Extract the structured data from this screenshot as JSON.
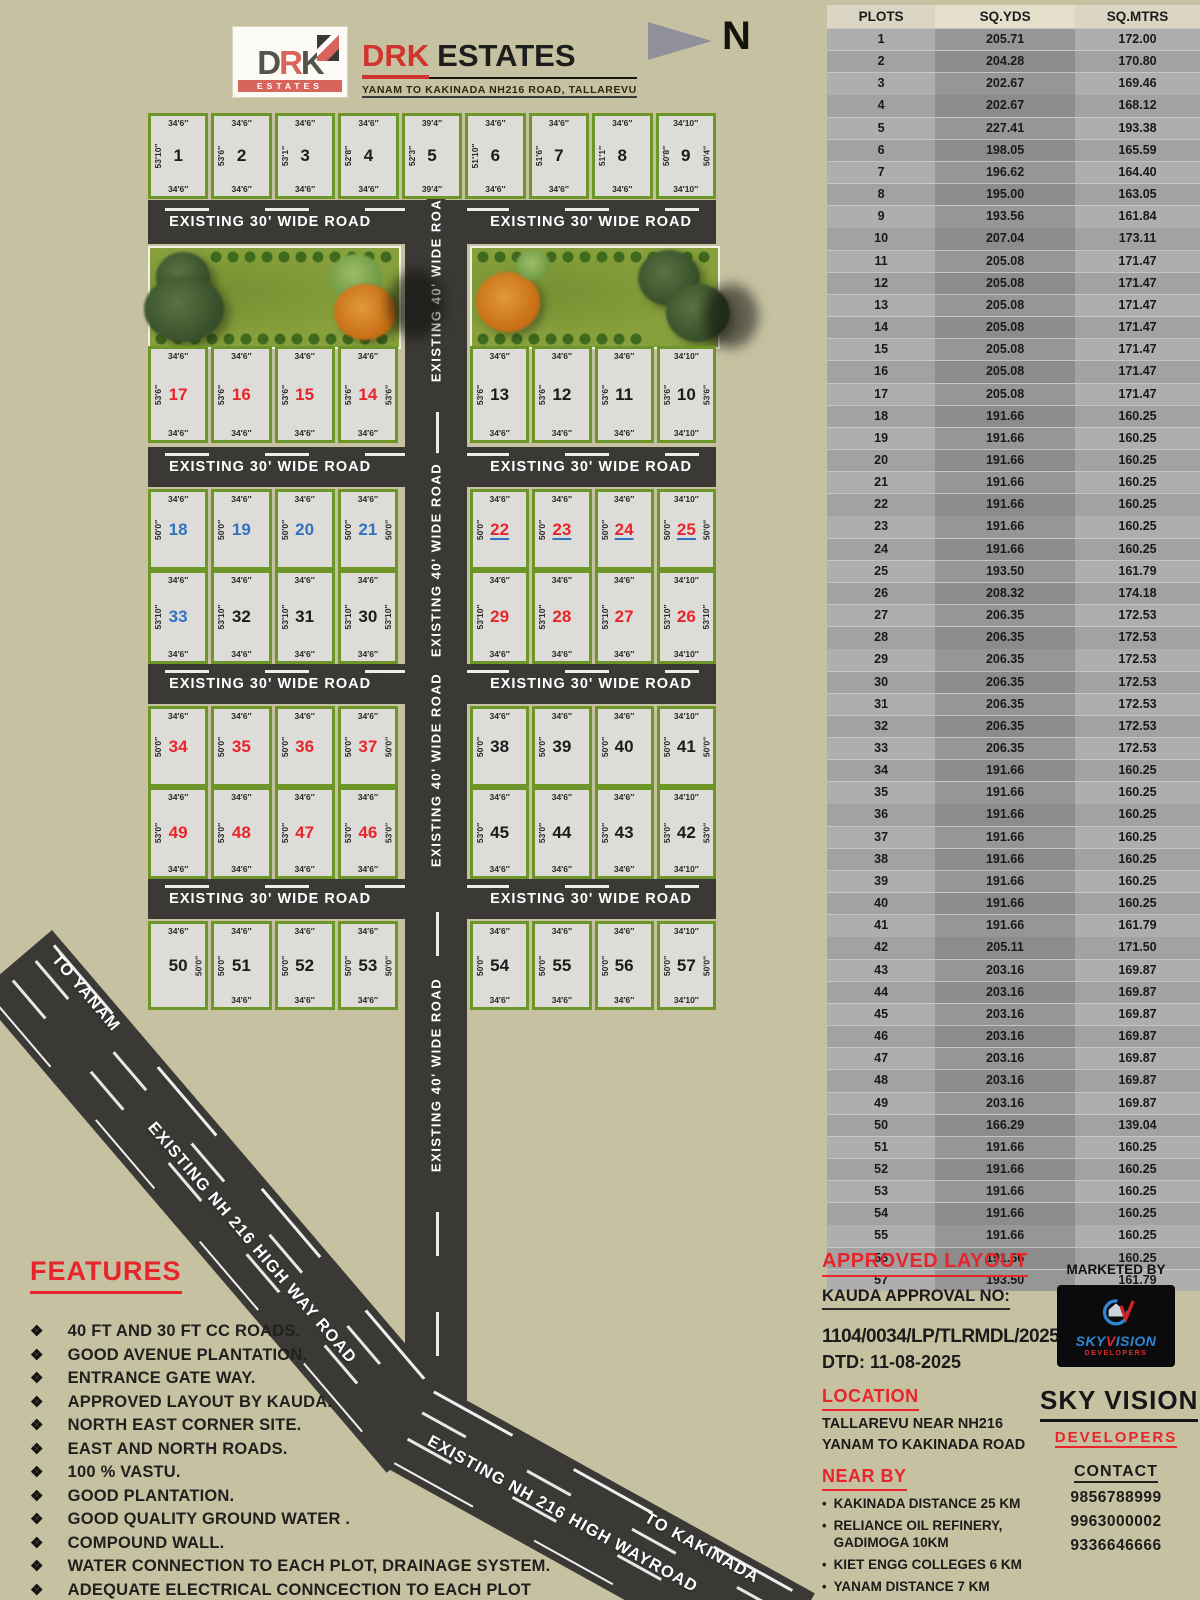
{
  "brand": {
    "logo_top": "DRK",
    "logo_band": "ESTATES",
    "title_red": "DRK",
    "title_black": "ESTATES",
    "subtitle": "YANAM TO KAKINADA NH216 ROAD, TALLAREVU"
  },
  "north_label": "N",
  "plan": {
    "road30_label": "EXISTING 30' WIDE  ROAD",
    "road40_label": "EXISTING 40' WIDE  ROAD",
    "highway_upper_label": "EXISTING NH 216 HIGH WAY ROAD",
    "highway_lower_label": "EXISTING NH 216 HIGH WAYROAD",
    "to_yanam": "TO YANAM",
    "to_kakinada": "TO KAKINADA",
    "hroads": [
      {
        "y": 200,
        "h": 44
      },
      {
        "y": 447,
        "h": 40
      },
      {
        "y": 664,
        "h": 40
      },
      {
        "y": 879,
        "h": 40
      }
    ],
    "rows": [
      {
        "y": 113,
        "h": 86,
        "blocks": [
          {
            "x": 148,
            "w": 568,
            "plots": [
              {
                "n": "1",
                "c": "k",
                "t": "34′6″",
                "b": "34′6″",
                "l": "53′10″"
              },
              {
                "n": "2",
                "c": "k",
                "t": "34′6″",
                "b": "34′6″",
                "l": "53′6″"
              },
              {
                "n": "3",
                "c": "k",
                "t": "34′6″",
                "b": "34′6″",
                "l": "53′1″"
              },
              {
                "n": "4",
                "c": "k",
                "t": "34′6″",
                "b": "34′6″",
                "l": "52′8″"
              },
              {
                "n": "5",
                "c": "k",
                "t": "39′4″",
                "b": "39′4″",
                "l": "52′3″"
              },
              {
                "n": "6",
                "c": "k",
                "t": "34′6″",
                "b": "34′6″",
                "l": "51′10″"
              },
              {
                "n": "7",
                "c": "k",
                "t": "34′6″",
                "b": "34′6″",
                "l": "51′6″"
              },
              {
                "n": "8",
                "c": "k",
                "t": "34′6″",
                "b": "34′6″",
                "l": "51′1″"
              },
              {
                "n": "9",
                "c": "k",
                "t": "34′10″",
                "b": "34′10″",
                "l": "50′8″",
                "r": "50′4″"
              }
            ]
          }
        ]
      },
      {
        "y": 346,
        "h": 97,
        "blocks": [
          {
            "x": 148,
            "w": 250,
            "plots": [
              {
                "n": "17",
                "c": "r",
                "t": "34′6″",
                "b": "34′6″",
                "l": "53′6″"
              },
              {
                "n": "16",
                "c": "r",
                "t": "34′6″",
                "b": "34′6″",
                "l": "53′6″"
              },
              {
                "n": "15",
                "c": "r",
                "t": "34′6″",
                "b": "34′6″",
                "l": "53′6″"
              },
              {
                "n": "14",
                "c": "r",
                "t": "34′6″",
                "b": "34′6″",
                "l": "53′6″",
                "r": "53′6″"
              }
            ]
          },
          {
            "x": 470,
            "w": 246,
            "plots": [
              {
                "n": "13",
                "c": "k",
                "t": "34′6″",
                "b": "34′6″",
                "l": "53′6″"
              },
              {
                "n": "12",
                "c": "k",
                "t": "34′6″",
                "b": "34′6″",
                "l": "53′6″"
              },
              {
                "n": "11",
                "c": "k",
                "t": "34′6″",
                "b": "34′6″",
                "l": "53′6″"
              },
              {
                "n": "10",
                "c": "k",
                "t": "34′10″",
                "b": "34′10″",
                "l": "53′6″",
                "r": "53′6″"
              }
            ]
          }
        ]
      },
      {
        "y": 489,
        "h": 81,
        "blocks": [
          {
            "x": 148,
            "w": 250,
            "plots": [
              {
                "n": "18",
                "c": "b",
                "t": "34′6″",
                "l": "50′0″"
              },
              {
                "n": "19",
                "c": "b",
                "t": "34′6″",
                "l": "50′0″"
              },
              {
                "n": "20",
                "c": "b",
                "t": "34′6″",
                "l": "50′0″"
              },
              {
                "n": "21",
                "c": "b",
                "t": "34′6″",
                "l": "50′0″",
                "r": "50′0″"
              }
            ]
          },
          {
            "x": 470,
            "w": 246,
            "plots": [
              {
                "n": "22",
                "c": "ru",
                "t": "34′6″",
                "l": "50′0″"
              },
              {
                "n": "23",
                "c": "ru",
                "t": "34′6″",
                "l": "50′0″"
              },
              {
                "n": "24",
                "c": "ru",
                "t": "34′6″",
                "l": "50′0″"
              },
              {
                "n": "25",
                "c": "ru",
                "t": "34′10″",
                "l": "50′0″",
                "r": "50′0″"
              }
            ]
          }
        ]
      },
      {
        "y": 570,
        "h": 94,
        "blocks": [
          {
            "x": 148,
            "w": 250,
            "plots": [
              {
                "n": "33",
                "c": "b",
                "t": "34′6″",
                "b": "34′6″",
                "l": "53′10″"
              },
              {
                "n": "32",
                "c": "k",
                "t": "34′6″",
                "b": "34′6″",
                "l": "53′10″"
              },
              {
                "n": "31",
                "c": "k",
                "t": "34′6″",
                "b": "34′6″",
                "l": "53′10″"
              },
              {
                "n": "30",
                "c": "k",
                "t": "34′6″",
                "b": "34′6″",
                "l": "53′10″",
                "r": "53′10″"
              }
            ]
          },
          {
            "x": 470,
            "w": 246,
            "plots": [
              {
                "n": "29",
                "c": "r",
                "t": "34′6″",
                "b": "34′6″",
                "l": "53′10″"
              },
              {
                "n": "28",
                "c": "r",
                "t": "34′6″",
                "b": "34′6″",
                "l": "53′10″"
              },
              {
                "n": "27",
                "c": "r",
                "t": "34′6″",
                "b": "34′6″",
                "l": "53′10″"
              },
              {
                "n": "26",
                "c": "r",
                "t": "34′10″",
                "b": "34′10″",
                "l": "53′10″",
                "r": "53′10″"
              }
            ]
          }
        ]
      },
      {
        "y": 706,
        "h": 81,
        "blocks": [
          {
            "x": 148,
            "w": 250,
            "plots": [
              {
                "n": "34",
                "c": "r",
                "t": "34′6″",
                "l": "50′0″"
              },
              {
                "n": "35",
                "c": "r",
                "t": "34′6″",
                "l": "50′0″"
              },
              {
                "n": "36",
                "c": "r",
                "t": "34′6″",
                "l": "50′0″"
              },
              {
                "n": "37",
                "c": "r",
                "t": "34′6″",
                "l": "50′0″",
                "r": "50′0″"
              }
            ]
          },
          {
            "x": 470,
            "w": 246,
            "plots": [
              {
                "n": "38",
                "c": "k",
                "t": "34′6″",
                "l": "50′0″"
              },
              {
                "n": "39",
                "c": "k",
                "t": "34′6″",
                "l": "50′0″"
              },
              {
                "n": "40",
                "c": "k",
                "t": "34′6″",
                "l": "50′0″"
              },
              {
                "n": "41",
                "c": "k",
                "t": "34′10″",
                "l": "50′0″",
                "r": "50′0″"
              }
            ]
          }
        ]
      },
      {
        "y": 787,
        "h": 92,
        "blocks": [
          {
            "x": 148,
            "w": 250,
            "plots": [
              {
                "n": "49",
                "c": "r",
                "t": "34′6″",
                "b": "34′6″",
                "l": "53′0″"
              },
              {
                "n": "48",
                "c": "r",
                "t": "34′6″",
                "b": "34′6″",
                "l": "53′0″"
              },
              {
                "n": "47",
                "c": "r",
                "t": "34′6″",
                "b": "34′6″",
                "l": "53′0″"
              },
              {
                "n": "46",
                "c": "r",
                "t": "34′6″",
                "b": "34′6″",
                "l": "53′0″",
                "r": "53′0″"
              }
            ]
          },
          {
            "x": 470,
            "w": 246,
            "plots": [
              {
                "n": "45",
                "c": "k",
                "t": "34′6″",
                "b": "34′6″",
                "l": "53′0″"
              },
              {
                "n": "44",
                "c": "k",
                "t": "34′6″",
                "b": "34′6″",
                "l": "53′0″"
              },
              {
                "n": "43",
                "c": "k",
                "t": "34′6″",
                "b": "34′6″",
                "l": "53′0″"
              },
              {
                "n": "42",
                "c": "k",
                "t": "34′10″",
                "b": "34′10″",
                "l": "53′0″",
                "r": "53′0″"
              }
            ]
          }
        ]
      },
      {
        "y": 921,
        "h": 89,
        "blocks": [
          {
            "x": 148,
            "w": 250,
            "plots": [
              {
                "n": "50",
                "c": "k",
                "t": "34′6″",
                "r": "50′0″"
              },
              {
                "n": "51",
                "c": "k",
                "t": "34′6″",
                "b": "34′6″",
                "l": "50′0″"
              },
              {
                "n": "52",
                "c": "k",
                "t": "34′6″",
                "b": "34′6″",
                "l": "50′0″"
              },
              {
                "n": "53",
                "c": "k",
                "t": "34′6″",
                "b": "34′6″",
                "l": "50′0″",
                "r": "50′0″"
              }
            ]
          },
          {
            "x": 470,
            "w": 246,
            "plots": [
              {
                "n": "54",
                "c": "k",
                "t": "34′6″",
                "b": "34′6″",
                "l": "50′0″"
              },
              {
                "n": "55",
                "c": "k",
                "t": "34′6″",
                "b": "34′6″",
                "l": "50′0″"
              },
              {
                "n": "56",
                "c": "k",
                "t": "34′6″",
                "b": "34′6″",
                "l": "50′0″"
              },
              {
                "n": "57",
                "c": "k",
                "t": "34′10″",
                "b": "34′10″",
                "l": "50′0″",
                "r": "50′0″"
              }
            ]
          }
        ]
      }
    ]
  },
  "table": {
    "headers": [
      "PLOTS",
      "SQ.YDS",
      "SQ.MTRS"
    ],
    "rows": [
      [
        "1",
        "205.71",
        "172.00"
      ],
      [
        "2",
        "204.28",
        "170.80"
      ],
      [
        "3",
        "202.67",
        "169.46"
      ],
      [
        "4",
        "202.67",
        "168.12"
      ],
      [
        "5",
        "227.41",
        "193.38"
      ],
      [
        "6",
        "198.05",
        "165.59"
      ],
      [
        "7",
        "196.62",
        "164.40"
      ],
      [
        "8",
        "195.00",
        "163.05"
      ],
      [
        "9",
        "193.56",
        "161.84"
      ],
      [
        "10",
        "207.04",
        "173.11"
      ],
      [
        "11",
        "205.08",
        "171.47"
      ],
      [
        "12",
        "205.08",
        "171.47"
      ],
      [
        "13",
        "205.08",
        "171.47"
      ],
      [
        "14",
        "205.08",
        "171.47"
      ],
      [
        "15",
        "205.08",
        "171.47"
      ],
      [
        "16",
        "205.08",
        "171.47"
      ],
      [
        "17",
        "205.08",
        "171.47"
      ],
      [
        "18",
        "191.66",
        "160.25"
      ],
      [
        "19",
        "191.66",
        "160.25"
      ],
      [
        "20",
        "191.66",
        "160.25"
      ],
      [
        "21",
        "191.66",
        "160.25"
      ],
      [
        "22",
        "191.66",
        "160.25"
      ],
      [
        "23",
        "191.66",
        "160.25"
      ],
      [
        "24",
        "191.66",
        "160.25"
      ],
      [
        "25",
        "193.50",
        "161.79"
      ],
      [
        "26",
        "208.32",
        "174.18"
      ],
      [
        "27",
        "206.35",
        "172.53"
      ],
      [
        "28",
        "206.35",
        "172.53"
      ],
      [
        "29",
        "206.35",
        "172.53"
      ],
      [
        "30",
        "206.35",
        "172.53"
      ],
      [
        "31",
        "206.35",
        "172.53"
      ],
      [
        "32",
        "206.35",
        "172.53"
      ],
      [
        "33",
        "206.35",
        "172.53"
      ],
      [
        "34",
        "191.66",
        "160.25"
      ],
      [
        "35",
        "191.66",
        "160.25"
      ],
      [
        "36",
        "191.66",
        "160.25"
      ],
      [
        "37",
        "191.66",
        "160.25"
      ],
      [
        "38",
        "191.66",
        "160.25"
      ],
      [
        "39",
        "191.66",
        "160.25"
      ],
      [
        "40",
        "191.66",
        "160.25"
      ],
      [
        "41",
        "191.66",
        "161.79"
      ],
      [
        "42",
        "205.11",
        "171.50"
      ],
      [
        "43",
        "203.16",
        "169.87"
      ],
      [
        "44",
        "203.16",
        "169.87"
      ],
      [
        "45",
        "203.16",
        "169.87"
      ],
      [
        "46",
        "203.16",
        "169.87"
      ],
      [
        "47",
        "203.16",
        "169.87"
      ],
      [
        "48",
        "203.16",
        "169.87"
      ],
      [
        "49",
        "203.16",
        "169.87"
      ],
      [
        "50",
        "166.29",
        "139.04"
      ],
      [
        "51",
        "191.66",
        "160.25"
      ],
      [
        "52",
        "191.66",
        "160.25"
      ],
      [
        "53",
        "191.66",
        "160.25"
      ],
      [
        "54",
        "191.66",
        "160.25"
      ],
      [
        "55",
        "191.66",
        "160.25"
      ],
      [
        "56",
        "191.66",
        "160.25"
      ],
      [
        "57",
        "193.50",
        "161.79"
      ]
    ]
  },
  "features": {
    "title": "FEATURES",
    "bullet": "❖",
    "items": [
      "40 FT AND 30 FT CC ROADS.",
      "GOOD AVENUE PLANTATION.",
      "ENTRANCE GATE WAY.",
      "APPROVED LAYOUT BY KAUDA.",
      "NORTH EAST CORNER SITE.",
      "EAST AND NORTH ROADS.",
      "100 % VASTU.",
      "GOOD PLANTATION.",
      "GOOD QUALITY GROUND WATER .",
      "COMPOUND WALL.",
      "WATER CONNECTION TO EACH PLOT, DRAINAGE SYSTEM.",
      "ADEQUATE  ELECTRICAL CONNCECTION TO EACH PLOT"
    ]
  },
  "info": {
    "approved_title": "APPROVED LAYOUT",
    "kauda": "KAUDA APPROVAL NO:",
    "approval_no": "1104/0034/LP/TLRMDL/2025",
    "dtd": "DTD: 11-08-2025",
    "location_title": "LOCATION",
    "location_lines": [
      "TALLAREVU NEAR NH216",
      "YANAM TO KAKINADA ROAD"
    ],
    "nearby_title": "NEAR BY",
    "nearby_bullet": "•",
    "nearby_items": [
      "KAKINADA DISTANCE 25 KM",
      "RELIANCE OIL REFINERY, GADIMOGA 10KM",
      "KIET ENGG COLLEGES 6 KM",
      "YANAM DISTANCE 7 KM"
    ],
    "marketed_by": "MARKETED BY",
    "logo_sky": "SKY",
    "logo_v": "V",
    "logo_ision": "ISION",
    "logo_sub": "DEVELOPERS",
    "developer_name": "SKY VISION",
    "developer_sub": "DEVELOPERS",
    "contact_title": "CONTACT",
    "phones": [
      "9856788999",
      "9963000002",
      "9336646666"
    ]
  },
  "colors": {
    "background": "#c6c2a1",
    "road": "#3a3936",
    "plot_border_green": "#6e9527",
    "accent_red": "#e8252b",
    "accent_blue": "#2f74c0"
  }
}
